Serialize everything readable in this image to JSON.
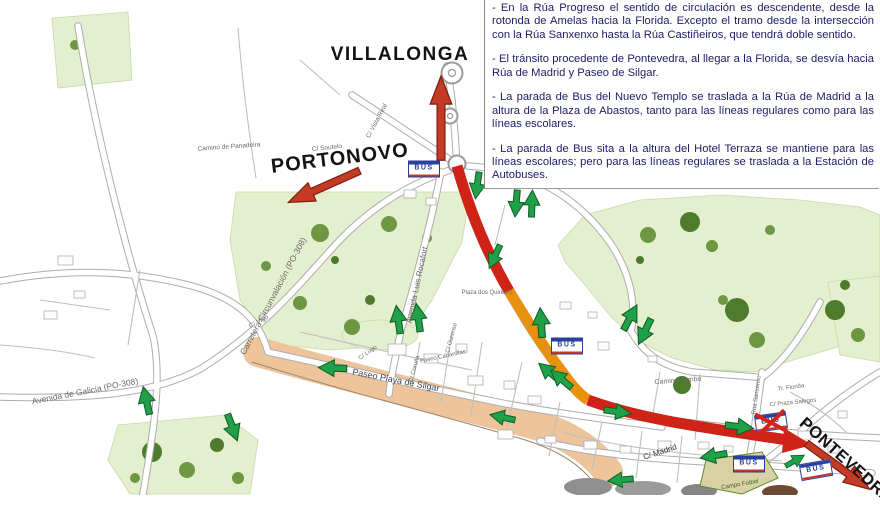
{
  "panel": {
    "bullets": [
      "- En la Rúa Progreso el sentido de circulación es descendente, desde la rotonda de Amelas hacia la Florida. Excepto el tramo desde la intersección con la Rúa Sanxenxo hasta la Rúa Castiñeiros, que tendrá doble sentido.",
      "- El tránsito procedente de Pontevedra, al llegar a la Florida, se desvía hacia Rúa de Madrid y Paseo de Silgar.",
      "- La parada de Bus del Nuevo Templo se traslada a la Rúa de Madrid a la altura de la Plaza de Abastos, tanto para las líneas regulares como para las líneas escolares.",
      "- La parada de Bus sita a la altura del Hotel Terraza se mantiene para las líneas escolares; pero para las líneas regulares se traslada a la Estación de Autobuses."
    ]
  },
  "map": {
    "destination_labels": [
      {
        "text": "VILLALONGA"
      },
      {
        "text": "PORTONOVO"
      },
      {
        "text": "PONTEVEDRA"
      }
    ],
    "street_labels": [
      {
        "text": "Carretera Circunvalación (PO-308)"
      },
      {
        "text": "Avenida de Galicia (PO-308)"
      },
      {
        "text": "Avenida Luis Rocafort"
      },
      {
        "text": "Paseo Playa de Silgar"
      },
      {
        "text": "Camino Tombo"
      },
      {
        "text": "C/ Madrid"
      },
      {
        "text": "C/ Vigo"
      },
      {
        "text": "C/ Coruña"
      },
      {
        "text": "Paseo Cabanillas"
      },
      {
        "text": "Plaza dos Quintero"
      },
      {
        "text": "Camino de Panadeira"
      },
      {
        "text": "C/ Soutelo"
      },
      {
        "text": "Rúa Sanxenxo"
      },
      {
        "text": "Tr. Florida"
      },
      {
        "text": "C/ Praza Salegos"
      },
      {
        "text": "Campo Fútbol"
      },
      {
        "text": "C/ Vista Real"
      },
      {
        "text": "C/ Ourense"
      },
      {
        "text": "C/ Lugo"
      }
    ],
    "bus_stop_icon_label": "BUS",
    "legend_colors": {
      "one_way_route": "#cf2318",
      "diverted_section": "#e8910f",
      "allowed_direction_arrow": "#21a04a",
      "destination_arrow": "#c43a24",
      "park": "#e3efce",
      "beach": "#eec49b",
      "notes_text": "#1c1c66"
    }
  }
}
